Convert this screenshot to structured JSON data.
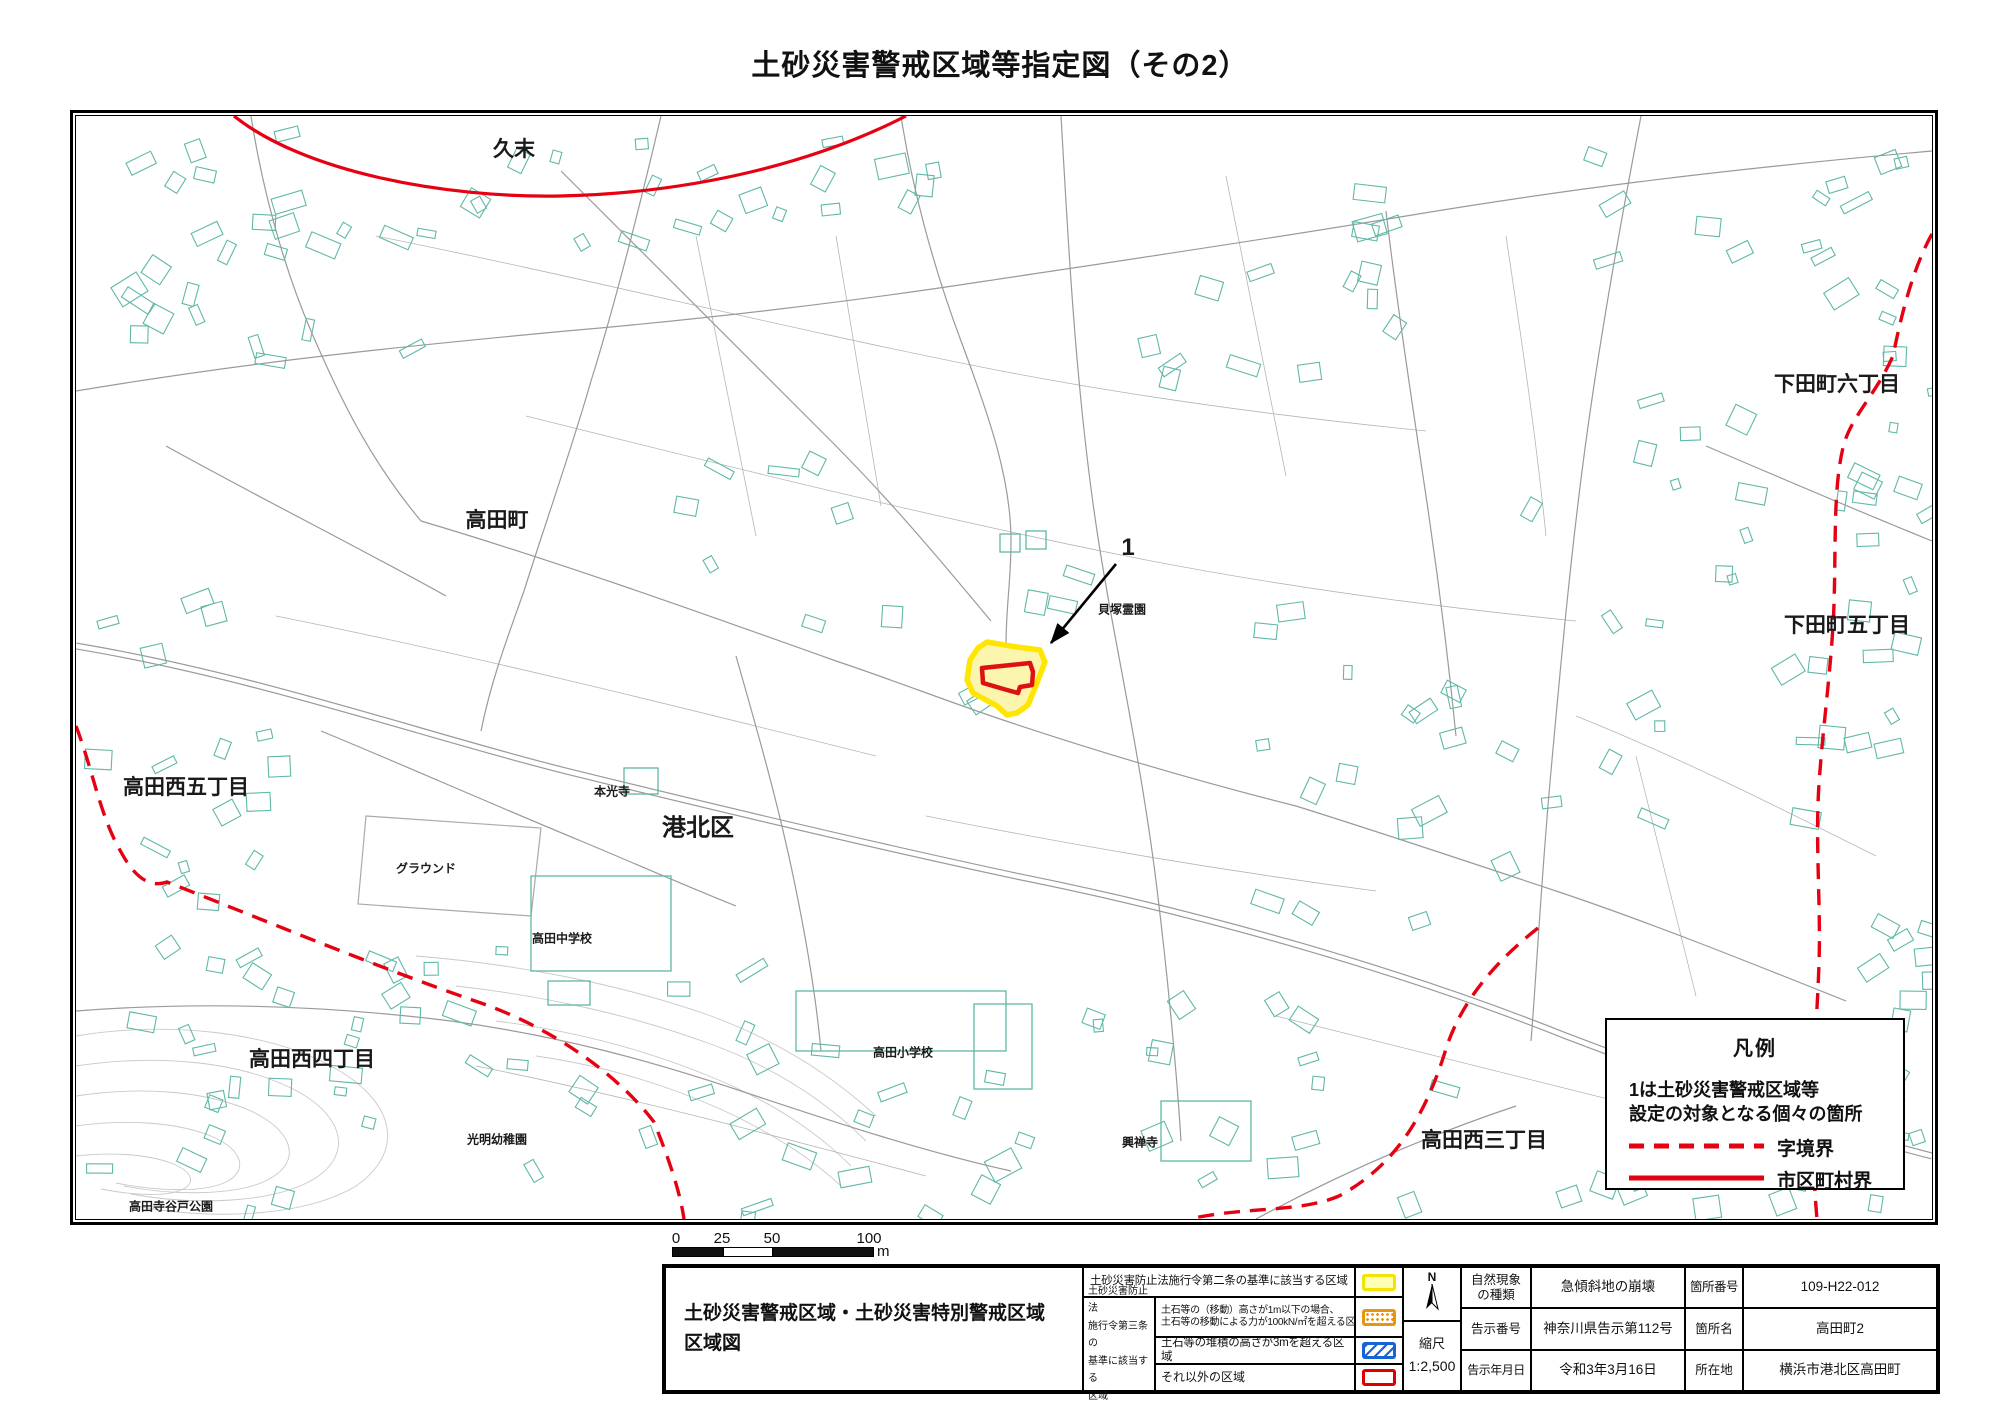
{
  "page": {
    "title": "土砂災害警戒区域等指定図（その2）"
  },
  "map": {
    "area_labels": [
      {
        "text": "久末"
      },
      {
        "text": "高田町"
      },
      {
        "text": "下田町六丁目"
      },
      {
        "text": "下田町五丁目"
      },
      {
        "text": "高田西五丁目"
      },
      {
        "text": "港北区"
      },
      {
        "text": "本光寺"
      },
      {
        "text": "グラウンド"
      },
      {
        "text": "高田中学校"
      },
      {
        "text": "高田西四丁目"
      },
      {
        "text": "光明幼稚園"
      },
      {
        "text": "高田寺谷戸公園"
      },
      {
        "text": "高田小学校"
      },
      {
        "text": "興禅寺"
      },
      {
        "text": "高田西三丁目"
      },
      {
        "text": "貝塚霊園"
      }
    ],
    "marker_label": "1"
  },
  "legend_box": {
    "title": "凡例",
    "note": [
      "1は土砂災害警戒区域等",
      "設定の対象となる個々の箇所"
    ],
    "items": [
      {
        "label": "字境界",
        "style": "dashed"
      },
      {
        "label": "市区町村界",
        "style": "solid"
      }
    ]
  },
  "scale_bar": {
    "ticks": [
      "0",
      "25",
      "50",
      "100"
    ],
    "unit": "m"
  },
  "table": {
    "doc_title": [
      "土砂災害警戒区域・土砂災害特別警戒区域",
      "区域図"
    ],
    "law2_label": "土砂災害防止法施行令第二条の基準に該当する区域",
    "law3_group": [
      "土砂災害防止法",
      "施行令第三条の",
      "基準に該当する",
      "区域"
    ],
    "law3_rows": {
      "r1": [
        "土石等の（移動）高さが1m以下の場合、",
        "土石等の移動による力が100kN/㎡を超える区域"
      ],
      "r2": "土石等の堆積の高さが3mを超える区域",
      "r3": "それ以外の区域"
    },
    "compass_n": "N",
    "scale_caption": "縮尺",
    "scale_value": "1:2,500",
    "fields_left": [
      {
        "label": [
          "自然現象",
          "の種類"
        ],
        "value": "急傾斜地の崩壊"
      },
      {
        "label": [
          "告示番号"
        ],
        "value": "神奈川県告示第112号"
      },
      {
        "label": [
          "告示年月日"
        ],
        "value": "令和3年3月16日"
      }
    ],
    "fields_right": [
      {
        "label": "箇所番号",
        "value": "109-H22-012"
      },
      {
        "label": "箇所名",
        "value": "高田町2"
      },
      {
        "label": "所在地",
        "value": "横浜市港北区高田町"
      }
    ]
  },
  "colors": {
    "boundary_red": "#e60012",
    "building_teal": "#5fb8a8",
    "zone_yellow_stroke": "#ffe600",
    "zone_yellow_fill": "#fbf5ae",
    "zone_red": "#dd1111",
    "swatch_yellow": "#f2e300",
    "swatch_orange": "#e8960f",
    "swatch_blue": "#1565d8",
    "swatch_red": "#dd0000"
  }
}
